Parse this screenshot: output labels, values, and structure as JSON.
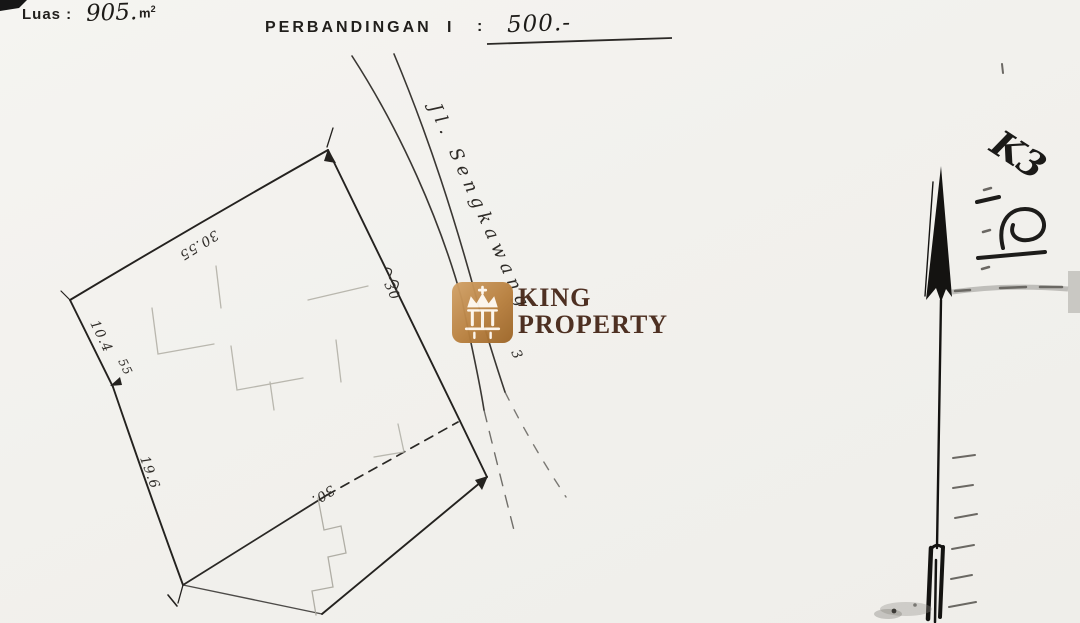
{
  "header": {
    "area_label": "Luas :",
    "area_value": "905.",
    "area_unit_base": "m",
    "area_unit_exp": "2",
    "scale_label": "PERBANDINGAN",
    "scale_index": "I",
    "scale_colon": ":",
    "scale_value": "500.-"
  },
  "watermark": {
    "brand_top": "KING",
    "brand_bottom": "PROPERTY",
    "icon": "crown-icon",
    "tile_color": "#b8803f",
    "text_color": "#48291a"
  },
  "site_plan": {
    "street_name": "Jl. Sengkawang",
    "street_annotation": "3",
    "dimensions": {
      "top_edge": "30.55",
      "left_upper_edge": "10.4",
      "left_bend": "55",
      "left_lower_edge": "19.6",
      "inner_dashed_line": "30.",
      "road_side_edge": "30"
    },
    "handwritten_mark_top_right": "K3",
    "ink_color": "#2a2724",
    "faint_line_color": "#b3b1a8"
  }
}
